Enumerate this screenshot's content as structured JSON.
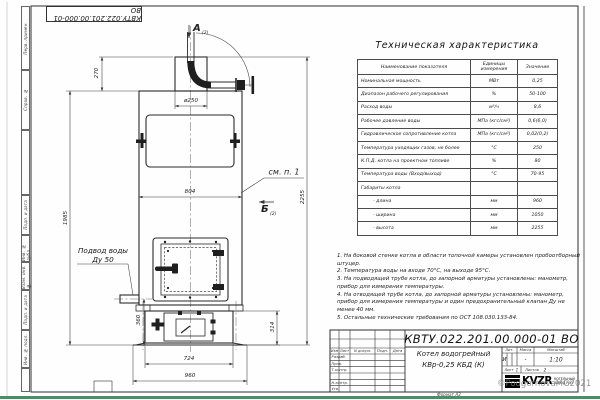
{
  "sheet": {
    "doc_number": "КВТУ.022.201.00.000-01 ВО",
    "format_label": "Формат А3",
    "watermark": "©PodgornovaMG2021",
    "margin_labels": [
      "Перв. примен.",
      "Справ. №",
      "",
      "Подп. и дата",
      "Инв. № дубл.",
      "Взам. инв. №",
      "Подп. и дата",
      "Инв. № подл.",
      ""
    ]
  },
  "drawing": {
    "view_a": "А",
    "view_a_sub": "(2)",
    "view_b": "Б",
    "view_b_sub": "(2)",
    "see_note": "см. п. 1",
    "water_inlet": "Подвод воды",
    "water_inlet_dn": "Ду 50",
    "dims": {
      "collar_height": "270",
      "chimney_dia": "ø250",
      "body_width": "804",
      "body_height": "1985",
      "total_height": "2255",
      "base_height": "360",
      "base_right": "314",
      "base_width": "724",
      "foundation_width": "960"
    }
  },
  "spec_table": {
    "title": "Техническая характеристика",
    "col_name": "Наименование показателя",
    "col_units": "Единицы измерения",
    "col_value": "Значение",
    "rows": [
      [
        "Номинальная мощность",
        "МВт",
        "0,25"
      ],
      [
        "Диапазон рабочего регулирования",
        "%",
        "50-100"
      ],
      [
        "Расход воды",
        "м³/ч",
        "8,6"
      ],
      [
        "Рабочее давление воды",
        "МПа (кгс/см²)",
        "0,6(6,0)"
      ],
      [
        "Гидравлическое сопротивление котла",
        "МПа (кгс/см²)",
        "0,02(0,2)"
      ],
      [
        "Температура уходящих газов, не более",
        "°С",
        "250"
      ],
      [
        "К.П.Д. котла на проектном топливе",
        "%",
        "80"
      ],
      [
        "Температура воды (Вход/выход)",
        "°С",
        "70-95"
      ],
      [
        "Габариты котла",
        "",
        ""
      ],
      [
        "- длина",
        "мм",
        "960"
      ],
      [
        "- ширина",
        "мм",
        "1050"
      ],
      [
        "- высота",
        "мм",
        "2255"
      ]
    ]
  },
  "notes": [
    "1. На боковой стенке котла в области топочной камеры установлен пробоотборный штуцер.",
    "2. Температура воды на входе 70°С, на выходе 95°С.",
    "3. На подводящей трубе котла, до запорной арматуры установлены: манометр, прибор для измерения температуры.",
    "4. На отводящей трубе котла, до запорной арматуры установлены: манометр, прибор для измерения температуры и один предохранительный клапан Ду не менее 40 мм.",
    "5. Остальные технические требования по ОСТ 108.030.133-84."
  ],
  "title_block": {
    "header_cells": [
      "Изм",
      "Лист",
      "N докум.",
      "Подп.",
      "Дата"
    ],
    "row_labels": [
      "Разраб.",
      "Пров.",
      "Т.контр.",
      "Н.контр.",
      "Утв."
    ],
    "product_line1": "Котел водогрейный",
    "product_line2": "КВр-0,25  КБД  (К)",
    "lit_label": "Лит.",
    "mass_label": "Масса",
    "scale_label": "Масштаб",
    "lit_value": "И",
    "mass_value": "-",
    "scale_value": "1:10",
    "sheet_label": "Лист",
    "sheet_value": "1",
    "sheets_label": "Листов",
    "sheets_value": "2",
    "logo_text": "KVZR",
    "logo_caption1": "КОТЕЛЬНЫЙ",
    "logo_caption2": "ЗАВОД РЭП"
  }
}
